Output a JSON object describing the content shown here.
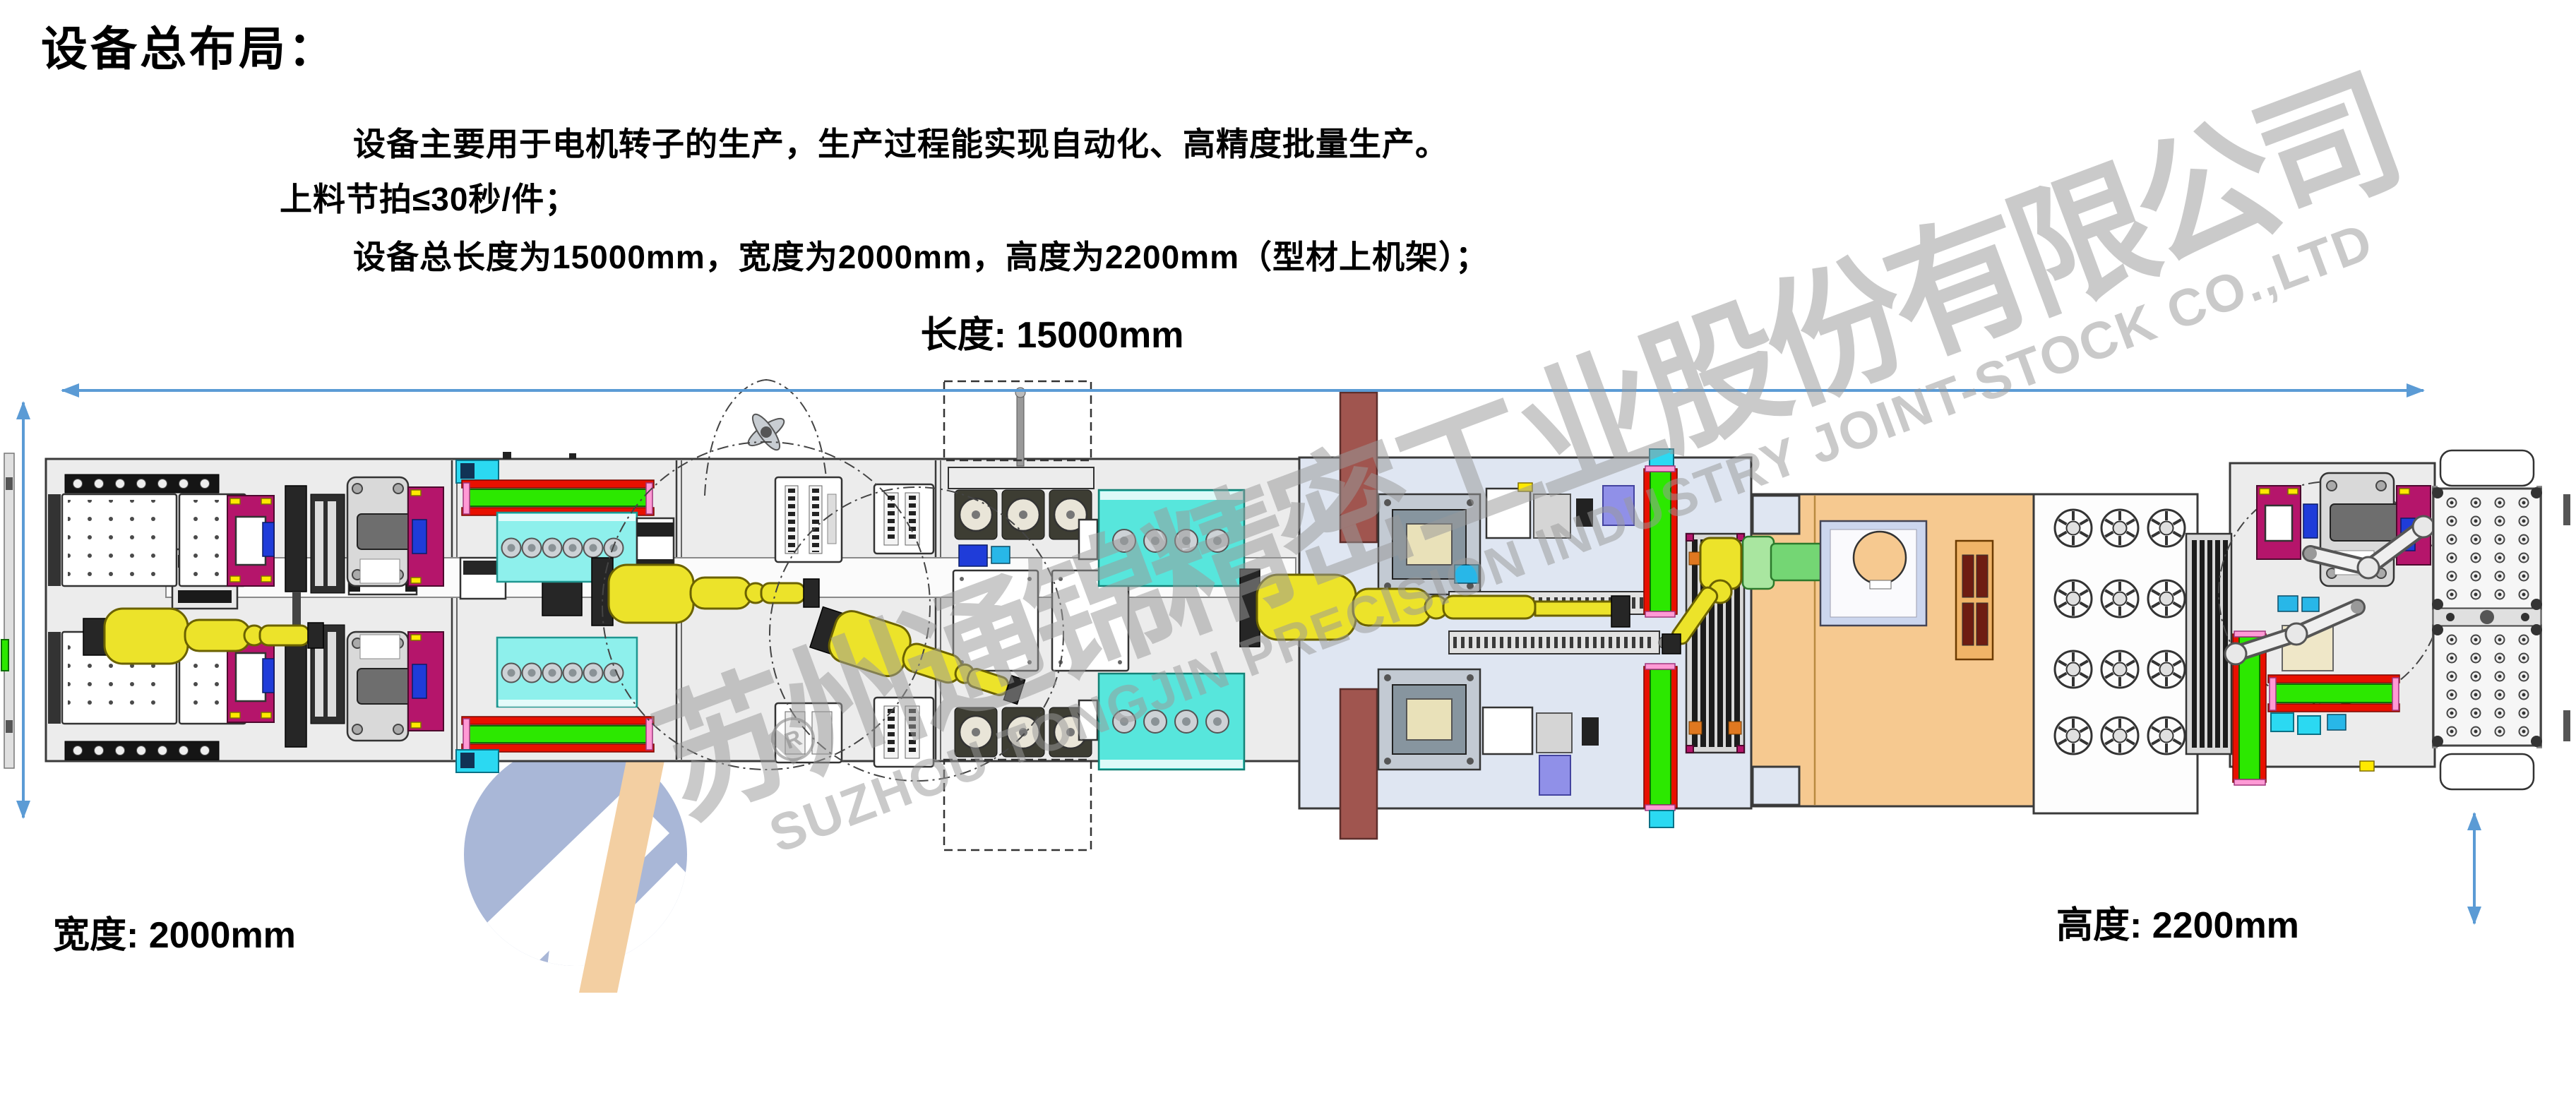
{
  "page": {
    "title": "设备总布局："
  },
  "description": {
    "line1": "设备主要用于电机转子的生产，生产过程能实现自动化、高精度批量生产。",
    "line2": "上料节拍≤30秒/件；",
    "line3": "设备总长度为15000mm，宽度为2000mm，高度为2200mm（型材上机架）；"
  },
  "dimensions": {
    "length_label": "长度: 15000mm",
    "width_label": "宽度: 2000mm",
    "height_label": "高度: 2200mm"
  },
  "watermark": {
    "company_cn": "苏州通锦精密工业股份有限公司",
    "company_en": "SUZHOU TONGJIN PRECISION INDUSTRY JOINT-STOCK CO.,LTD",
    "registered_mark": "R"
  },
  "palette": {
    "dim_arrow": "#5b9bd5",
    "bed_gray": "#ececec",
    "bed_lavender": "#dfe6f2",
    "bed_orange": "#f6c990",
    "robot_yellow": "#ece32a",
    "conveyor_green": "#2ce800",
    "conveyor_red": "#e81000",
    "box_cyan": "#8ef0ec",
    "box_teal": "#57e6dc",
    "fixture_magenta": "#b5156b",
    "accent_blue": "#1f3cd9",
    "bar_brown": "#a0554f",
    "watermark_gray": "#9a9a9a",
    "logo_blue": "#a9b7d7",
    "logo_orange": "#f3cfa2"
  }
}
